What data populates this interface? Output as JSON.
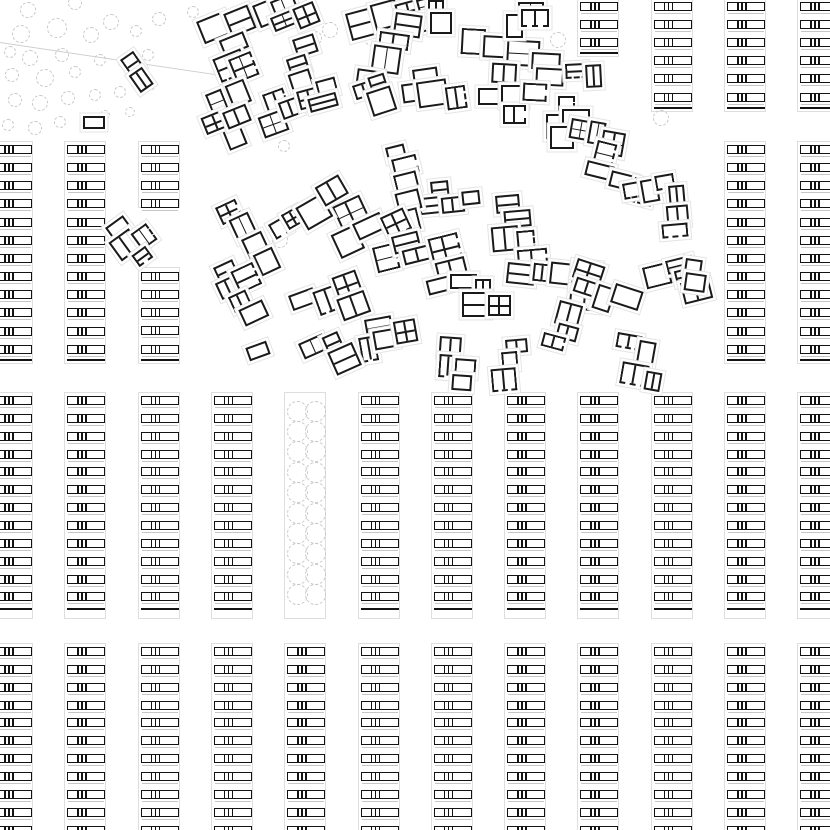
{
  "drawing": {
    "title": "Housing settlement site plan",
    "colors": {
      "background": "#ffffff",
      "wall": "#1a1a1a",
      "bar_wall": "#131313",
      "strip_outline": "#dedede",
      "hairline": "#c6c6c6",
      "tree": "#c9c9c9",
      "halo": "#e4e4e4",
      "boundary": "#cfcfcf"
    },
    "grid": {
      "strip_origin_x": -7,
      "strip_pitch": 73.3,
      "strip_outline_width": 42,
      "bar_width": 38,
      "bar_height": 9,
      "bar_divider_offsets": [
        9,
        13,
        17
      ],
      "hairline_offset": 11
    },
    "strip_segments_format": [
      "col_index",
      "first_bar_y",
      "bar_count",
      "bar_pitch",
      "end_line_y_or_null",
      "outline_top",
      "outline_bottom"
    ],
    "strip_segments": [
      [
        8,
        2,
        3,
        18.1,
        52,
        -2,
        57
      ],
      [
        9,
        2,
        6,
        18.1,
        107,
        -2,
        112
      ],
      [
        10,
        2,
        6,
        18.1,
        107,
        -2,
        112
      ],
      [
        11,
        2,
        6,
        18.1,
        107,
        -2,
        112
      ],
      [
        0,
        145,
        12,
        18.15,
        359,
        141,
        364
      ],
      [
        1,
        145,
        12,
        18.15,
        359,
        141,
        364
      ],
      [
        2,
        145,
        4,
        18.15,
        null,
        141,
        208
      ],
      [
        2,
        272,
        5,
        18.15,
        359,
        267,
        364
      ],
      [
        10,
        145,
        12,
        18.15,
        359,
        141,
        364
      ],
      [
        11,
        145,
        12,
        18.15,
        359,
        141,
        364
      ],
      [
        0,
        396,
        12,
        17.85,
        608,
        392,
        619
      ],
      [
        1,
        396,
        12,
        17.85,
        608,
        392,
        619
      ],
      [
        2,
        396,
        12,
        17.85,
        608,
        392,
        619
      ],
      [
        3,
        396,
        12,
        17.85,
        608,
        392,
        619
      ],
      [
        5,
        396,
        12,
        17.85,
        608,
        392,
        619
      ],
      [
        6,
        396,
        12,
        17.85,
        608,
        392,
        619
      ],
      [
        7,
        396,
        12,
        17.85,
        608,
        392,
        619
      ],
      [
        8,
        396,
        12,
        17.85,
        608,
        392,
        619
      ],
      [
        9,
        396,
        12,
        17.85,
        608,
        392,
        619
      ],
      [
        10,
        396,
        12,
        17.85,
        608,
        392,
        619
      ],
      [
        11,
        396,
        12,
        17.85,
        608,
        392,
        619
      ],
      [
        0,
        647,
        11,
        17.85,
        null,
        643,
        833
      ],
      [
        1,
        647,
        11,
        17.85,
        null,
        643,
        833
      ],
      [
        2,
        647,
        11,
        17.85,
        null,
        643,
        833
      ],
      [
        3,
        647,
        11,
        17.85,
        null,
        643,
        833
      ],
      [
        4,
        647,
        11,
        17.85,
        null,
        643,
        833
      ],
      [
        5,
        647,
        11,
        17.85,
        null,
        643,
        833
      ],
      [
        6,
        647,
        11,
        17.85,
        null,
        643,
        833
      ],
      [
        7,
        647,
        11,
        17.85,
        null,
        643,
        833
      ],
      [
        8,
        647,
        11,
        17.85,
        null,
        643,
        833
      ],
      [
        9,
        647,
        11,
        17.85,
        null,
        643,
        833
      ],
      [
        10,
        647,
        11,
        17.85,
        null,
        643,
        833
      ],
      [
        11,
        647,
        11,
        17.85,
        null,
        643,
        833
      ]
    ],
    "tree_strip": {
      "x": 284,
      "y": 392,
      "w": 42,
      "h": 227,
      "circle_centers_x": [
        12,
        30
      ],
      "rows": 10,
      "first_row_y": 18,
      "row_pitch": 20.4,
      "radius": 10.5
    },
    "trees_format": [
      "cx",
      "cy",
      "radius"
    ],
    "trees": [
      [
        28,
        10,
        8
      ],
      [
        75,
        3,
        7
      ],
      [
        111,
        22,
        8
      ],
      [
        57,
        28,
        10
      ],
      [
        21,
        34,
        9
      ],
      [
        91,
        35,
        8
      ],
      [
        136,
        31,
        6
      ],
      [
        159,
        19,
        7
      ],
      [
        193,
        12,
        6
      ],
      [
        10,
        52,
        6
      ],
      [
        30,
        58,
        8
      ],
      [
        62,
        55,
        7
      ],
      [
        100,
        60,
        6
      ],
      [
        125,
        62,
        7
      ],
      [
        148,
        55,
        6
      ],
      [
        12,
        75,
        7
      ],
      [
        45,
        78,
        9
      ],
      [
        75,
        72,
        6
      ],
      [
        15,
        100,
        7
      ],
      [
        40,
        103,
        8
      ],
      [
        68,
        98,
        7
      ],
      [
        95,
        95,
        6
      ],
      [
        120,
        92,
        6
      ],
      [
        150,
        86,
        5
      ],
      [
        8,
        125,
        6
      ],
      [
        35,
        128,
        7
      ],
      [
        60,
        122,
        6
      ],
      [
        105,
        115,
        5
      ],
      [
        130,
        112,
        5
      ],
      [
        312,
        18,
        9
      ],
      [
        330,
        30,
        8
      ],
      [
        315,
        38,
        7
      ],
      [
        372,
        38,
        8
      ],
      [
        408,
        8,
        7
      ],
      [
        558,
        40,
        8
      ],
      [
        661,
        118,
        8
      ],
      [
        284,
        146,
        6
      ],
      [
        280,
        240,
        8
      ]
    ],
    "buildings": {
      "groups_format": [
        "x",
        "y",
        "rotation_deg",
        "room_count",
        "base_size"
      ],
      "groups": [
        [
          120,
          60,
          -35,
          2,
          22
        ],
        [
          196,
          22,
          -22,
          4,
          24
        ],
        [
          252,
          6,
          -22,
          4,
          23
        ],
        [
          228,
          60,
          -22,
          4,
          24
        ],
        [
          292,
          40,
          -18,
          3,
          22
        ],
        [
          205,
          95,
          -22,
          3,
          23
        ],
        [
          262,
          95,
          -20,
          3,
          22
        ],
        [
          296,
          92,
          -15,
          3,
          22
        ],
        [
          345,
          14,
          -15,
          5,
          24
        ],
        [
          396,
          12,
          8,
          4,
          24
        ],
        [
          412,
          70,
          -8,
          4,
          24
        ],
        [
          462,
          28,
          3,
          4,
          25
        ],
        [
          478,
          88,
          0,
          3,
          23
        ],
        [
          532,
          52,
          3,
          3,
          23
        ],
        [
          565,
          64,
          -3,
          2,
          21
        ],
        [
          558,
          96,
          0,
          4,
          22
        ],
        [
          518,
          2,
          0,
          3,
          22
        ],
        [
          572,
          118,
          10,
          3,
          22
        ],
        [
          598,
          140,
          14,
          4,
          24
        ],
        [
          622,
          184,
          -10,
          3,
          22
        ],
        [
          668,
          186,
          -5,
          3,
          22
        ],
        [
          495,
          196,
          -5,
          5,
          25
        ],
        [
          430,
          182,
          -6,
          4,
          23
        ],
        [
          508,
          262,
          6,
          5,
          24
        ],
        [
          578,
          258,
          18,
          4,
          23
        ],
        [
          642,
          268,
          -14,
          4,
          23
        ],
        [
          686,
          258,
          8,
          2,
          22
        ],
        [
          385,
          148,
          -14,
          5,
          25
        ],
        [
          325,
          195,
          -25,
          5,
          24
        ],
        [
          268,
          225,
          -30,
          4,
          23
        ],
        [
          215,
          208,
          -25,
          4,
          23
        ],
        [
          105,
          228,
          -36,
          4,
          22
        ],
        [
          213,
          268,
          -25,
          5,
          24
        ],
        [
          288,
          296,
          -20,
          4,
          23
        ],
        [
          372,
          248,
          -14,
          6,
          24
        ],
        [
          450,
          274,
          0,
          4,
          23
        ],
        [
          364,
          320,
          -10,
          4,
          23
        ],
        [
          440,
          336,
          4,
          4,
          23
        ],
        [
          505,
          340,
          -5,
          3,
          22
        ],
        [
          298,
          344,
          -24,
          3,
          22
        ],
        [
          618,
          332,
          10,
          4,
          23
        ],
        [
          560,
          300,
          15,
          3,
          22
        ],
        [
          428,
          0,
          0,
          2,
          20
        ],
        [
          352,
          86,
          -18,
          3,
          23
        ]
      ],
      "solo_format": [
        "x",
        "y",
        "w",
        "h",
        "rotation_deg"
      ],
      "solo": [
        [
          83,
          116,
          22,
          13,
          0
        ],
        [
          247,
          344,
          22,
          14,
          -20
        ]
      ]
    },
    "boundary_line": {
      "x1": 0,
      "y1": 42,
      "x2": 228,
      "y2": 76
    }
  }
}
